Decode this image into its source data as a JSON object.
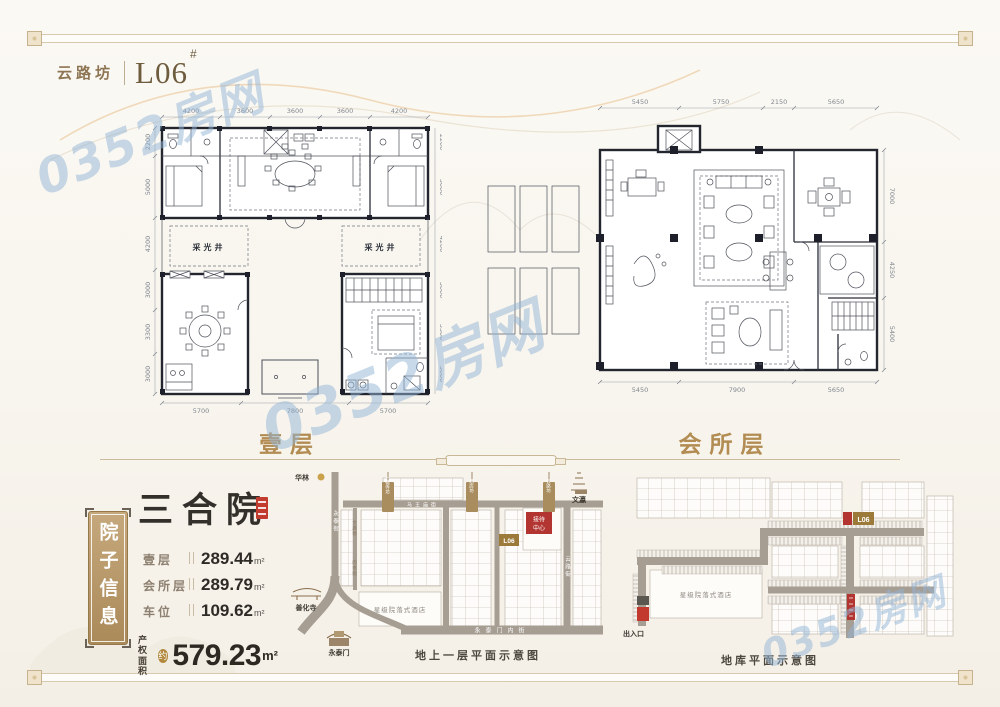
{
  "page": {
    "watermark": "0352房网",
    "title": {
      "project": "云路坊",
      "unit": "L06",
      "suffix": "#"
    }
  },
  "plans": {
    "first_floor": {
      "label": "壹层",
      "dims_top": [
        "4200",
        "3600",
        "3600",
        "3600",
        "4200"
      ],
      "dims_side": [
        "2200",
        "5000",
        "4200",
        "3000",
        "3300",
        "3000"
      ],
      "dims_bottom": [
        "5700",
        "7800",
        "5700"
      ],
      "light_well": "采光井"
    },
    "club_floor": {
      "label": "会所层",
      "dims_top": [
        "5450",
        "5750",
        "2150",
        "5650"
      ],
      "dims_right": [
        "7000",
        "4250",
        "5400"
      ],
      "dims_bottom": [
        "5450",
        "7900",
        "5650"
      ]
    }
  },
  "info_panel": {
    "plaque": "院子信息",
    "title": "三合院",
    "rows": [
      {
        "label": "壹层",
        "value": "289.44",
        "unit": "m²"
      },
      {
        "label": "会所层",
        "value": "289.79",
        "unit": "m²"
      },
      {
        "label": "车位",
        "value": "109.62",
        "unit": "m²"
      }
    ],
    "total_label_line1": "产权",
    "total_label_line2": "面积",
    "total_badge": "约",
    "total_value": "579.23",
    "total_unit": "m²"
  },
  "ground_map": {
    "caption": "地上一层平面示意图",
    "landmark_hualin": "华林",
    "landmark_wenying": "文瀛",
    "landmark_shanhuasi": "善化寺",
    "landmark_yongtaimen": "永泰门",
    "street_left": "永泰街",
    "street_right": "云路街",
    "street_bottom": "永泰门内街",
    "street_top": "马王庙街",
    "lane_1": "文旅巷",
    "lane_2": "肉市街",
    "hotel": "星级院落式酒店",
    "reception_line1": "接待",
    "reception_line2": "中心",
    "unit_tag": "L06",
    "banners": [
      "七佛寺坊",
      "酒店坊",
      "云路坊"
    ]
  },
  "garage_map": {
    "caption": "地库平面示意图",
    "hotel": "星级院落式酒店",
    "entrance": "出入口",
    "unit_tag": "L06"
  }
}
